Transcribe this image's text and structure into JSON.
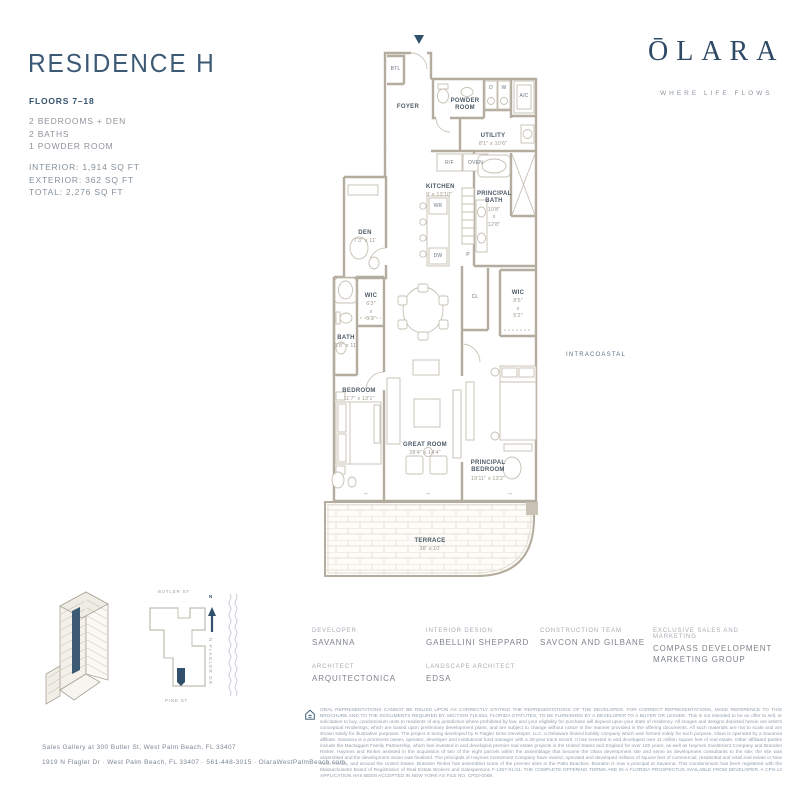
{
  "header": {
    "title": "RESIDENCE H",
    "floors": "FLOORS 7–18",
    "features": [
      "2 BEDROOMS + DEN",
      "2 BATHS",
      "1 POWDER ROOM"
    ],
    "areas": [
      "INTERIOR: 1,914 SQ FT",
      "EXTERIOR: 362 SQ FT",
      "TOTAL: 2,276 SQ FT"
    ]
  },
  "brand": {
    "logo": "ŌLARA",
    "tagline": "WHERE LIFE FLOWS"
  },
  "plan": {
    "rooms": {
      "foyer": {
        "name": "FOYER"
      },
      "btl": {
        "name": "BTL"
      },
      "powder": {
        "name": "POWDER\nROOM"
      },
      "utility": {
        "name": "UTILITY",
        "dims": "8'1\" x 10'6\""
      },
      "kitchen": {
        "name": "KITCHEN",
        "dims": "9' x 13'10\""
      },
      "principal_bath": {
        "name": "PRINCIPAL\nBATH",
        "dims": "10'8\"\nx\n12'8\""
      },
      "den": {
        "name": "DEN",
        "dims": "7'3\" x 11'"
      },
      "wic_a": {
        "name": "WIC",
        "dims": "6'3\"\nx\n5'3\""
      },
      "wic_b": {
        "name": "WIC",
        "dims": "8'5\"\nx\n5'2\""
      },
      "bath": {
        "name": "BATH",
        "dims": "5'8\" x 11'"
      },
      "bedroom": {
        "name": "BEDROOM",
        "dims": "11'7\" x 13'1\""
      },
      "great_room": {
        "name": "GREAT ROOM",
        "dims": "28'4\" x 14'4\""
      },
      "principal_bedroom": {
        "name": "PRINCIPAL\nBEDROOM",
        "dims": "19'11\" x 13'2\""
      },
      "terrace": {
        "name": "TERRACE",
        "dims": "38' x 10'"
      }
    },
    "fixtures": {
      "d": "D",
      "w": "W",
      "ac": "A/C",
      "rf": "R/F",
      "oven": "OVEN",
      "wr": "WR",
      "dw": "DW",
      "p": "P",
      "cl": "CL"
    },
    "context": {
      "water": "INTRACOASTAL"
    }
  },
  "keyplan": {
    "street_top": "BUTLER ST",
    "street_bottom": "PINE ST",
    "street_right": "N FLAGLER DR",
    "north": "N"
  },
  "credits": [
    {
      "label": "DEVELOPER",
      "value": "SAVANNA"
    },
    {
      "label": "ARCHITECT",
      "value": "ARQUITECTONICA"
    },
    {
      "label": "INTERIOR DESIGN",
      "value": "GABELLINI SHEPPARD"
    },
    {
      "label": "LANDSCAPE ARCHITECT",
      "value": "EDSA"
    },
    {
      "label": "CONSTRUCTION TEAM",
      "value": "SAVCON AND GILBANE"
    },
    {
      "label": "EXCLUSIVE SALES AND MARKETING",
      "value": "COMPASS DEVELOPMENT MARKETING GROUP"
    }
  ],
  "footer": {
    "address_line1": "Sales Gallery at 300 Butler St, West Palm Beach, FL 33407",
    "address_line2": "1919 N Flagler Dr  ·  West Palm Beach, FL 33407  ·  561-448-3015  ·  OlaraWestPalmBeach.com",
    "disclaimer": "ORAL REPRESENTATIONS CANNOT BE RELIED UPON AS CORRECTLY STATING THE REPRESENTATIONS OF THE DEVELOPER. FOR CORRECT REPRESENTATIONS, MAKE REFERENCE TO THIS BROCHURE AND TO THE DOCUMENTS REQUIRED BY SECTION 718.503, FLORIDA STATUTES, TO BE FURNISHED BY A DEVELOPER TO A BUYER OR LESSEE. This is not intended to be an offer to sell, or solicitation to buy, condominium units to residents of any jurisdiction where prohibited by law, and your eligibility for purchase will depend upon your state of residency. All images and designs depicted herein are artist's conceptual renderings, which are based upon preliminary development plans, and are subject to change without notice in the manner provided in the offering documents. All such materials are not to scale and are shown solely for illustrative purposes. The project is being developed by N Flagler Drive Developer, LLC, a Delaware limited liability company which was formed solely for such purpose. Olara is operated by a Savanna affiliate. Savanna is a prominent owner, operator, developer and institutional fund manager with a 30-year track record. It has invested in and developed over 11 million square feet of real estate. Other affiliated parties include the Mactaggart Family Partnership, which has invested in and developed premier real estate projects in the United States and England for over 100 years, as well as Haymes Investment Company and Brandon Rinker. Haymes and Rinker assisted in the acquisition of two of the eight parcels within the assemblage that became the Olara development site and serve as development consultants to the site; the site was assembled and the development vision was finalized. The principals of Haymes Investment Company have owned, operated and developed millions of square feet of commercial, residential and retail real estate in New York, Florida, and around the United States. Brandon Rinker has assembled some of the premier sites in the Palm Beaches. Brandon is now a principal at Savanna. This Condominium has been registered with the Massachusetts Board of Registration of Real Estate Brokers and Salespersons F-1257-01-01. THE COMPLETE OFFERING TERMS ARE IN A FLORIDA PROSPECTUS AVAILABLE FROM DEVELOPER. A CPS-12 APPLICATION HAS BEEN ACCEPTED IN NEW YORK AS FILE NO. CP22-0069."
  },
  "colors": {
    "navy": "#31506b",
    "wall": "#b4ac9e",
    "text_gray": "#8f949c"
  }
}
